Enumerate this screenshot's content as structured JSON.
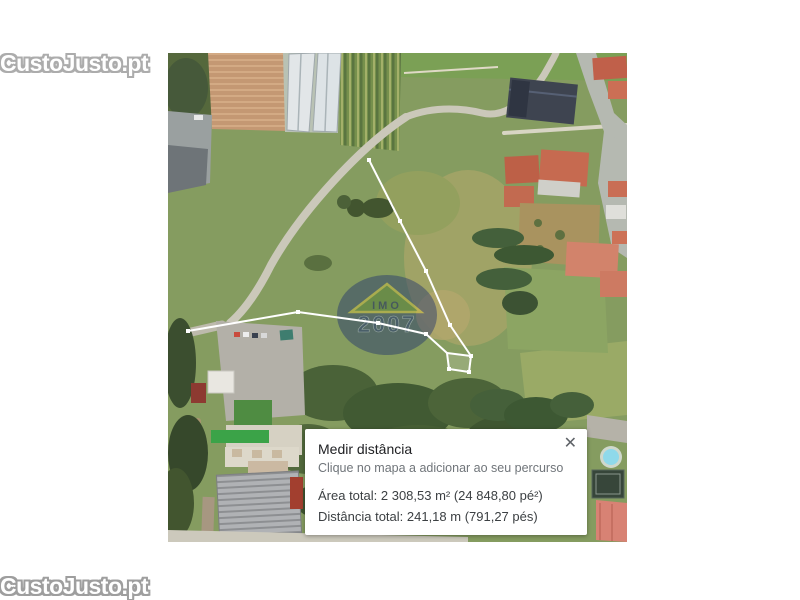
{
  "site_watermark": {
    "top": "CustoJusto.pt",
    "bottom": "CustoJusto.pt"
  },
  "map_watermark": {
    "abbr": "IMO",
    "year": "2007"
  },
  "dialog": {
    "title": "Medir distância",
    "subtitle": "Clique no mapa a adicionar ao seu percurso",
    "area_line": "Área total: 2 308,53 m² (24 848,80 pé²)",
    "distance_line": "Distância total: 241,18 m (791,27 pés)",
    "close_icon": "✕"
  },
  "measurement": {
    "area_m2": "2 308,53",
    "area_ft2": "24 848,80",
    "distance_m": "241,18",
    "distance_ft": "791,27"
  },
  "colors": {
    "measure_line": "#ffffff",
    "dialog_title": "#202124",
    "dialog_subtitle": "#70757a",
    "watermark_outline": "#9e9e9e",
    "agency_circle": "#1d2f6e"
  }
}
